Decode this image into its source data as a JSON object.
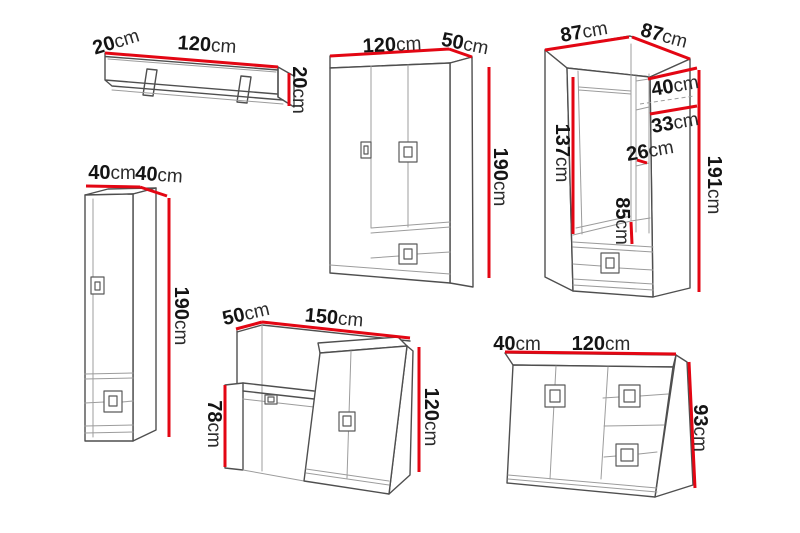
{
  "canvas": {
    "width": 800,
    "height": 533,
    "background": "#ffffff"
  },
  "colors": {
    "dimension_red": "#e30613",
    "outline_dark": "#4f4f4f",
    "outline_light": "#9c9c9c",
    "text": "#141414"
  },
  "furniture": {
    "wall_shelf": {
      "dims": {
        "depth": {
          "value": "20",
          "unit": "cm"
        },
        "width": {
          "value": "120",
          "unit": "cm"
        },
        "height": {
          "value": "20",
          "unit": "cm"
        }
      }
    },
    "column_cabinet": {
      "dims": {
        "width": {
          "value": "40",
          "unit": "cm"
        },
        "depth": {
          "value": "40",
          "unit": "cm"
        },
        "height": {
          "value": "190",
          "unit": "cm"
        }
      }
    },
    "wardrobe_3door": {
      "dims": {
        "width": {
          "value": "120",
          "unit": "cm"
        },
        "depth": {
          "value": "50",
          "unit": "cm"
        },
        "height": {
          "value": "190",
          "unit": "cm"
        }
      }
    },
    "corner_wardrobe": {
      "dims": {
        "width_left": {
          "value": "87",
          "unit": "cm"
        },
        "width_right": {
          "value": "87",
          "unit": "cm"
        },
        "top_shelf_gap": {
          "value": "40",
          "unit": "cm"
        },
        "shelf_gap": {
          "value": "33",
          "unit": "cm"
        },
        "lower_shelf_gap": {
          "value": "26",
          "unit": "cm"
        },
        "interior_height": {
          "value": "137",
          "unit": "cm"
        },
        "hanging_height": {
          "value": "85",
          "unit": "cm"
        },
        "height": {
          "value": "191",
          "unit": "cm"
        }
      }
    },
    "dressing_table": {
      "dims": {
        "depth": {
          "value": "50",
          "unit": "cm"
        },
        "width": {
          "value": "150",
          "unit": "cm"
        },
        "desk_height": {
          "value": "78",
          "unit": "cm"
        },
        "height": {
          "value": "120",
          "unit": "cm"
        }
      }
    },
    "chest": {
      "dims": {
        "depth": {
          "value": "40",
          "unit": "cm"
        },
        "width": {
          "value": "120",
          "unit": "cm"
        },
        "height": {
          "value": "93",
          "unit": "cm"
        }
      }
    }
  }
}
